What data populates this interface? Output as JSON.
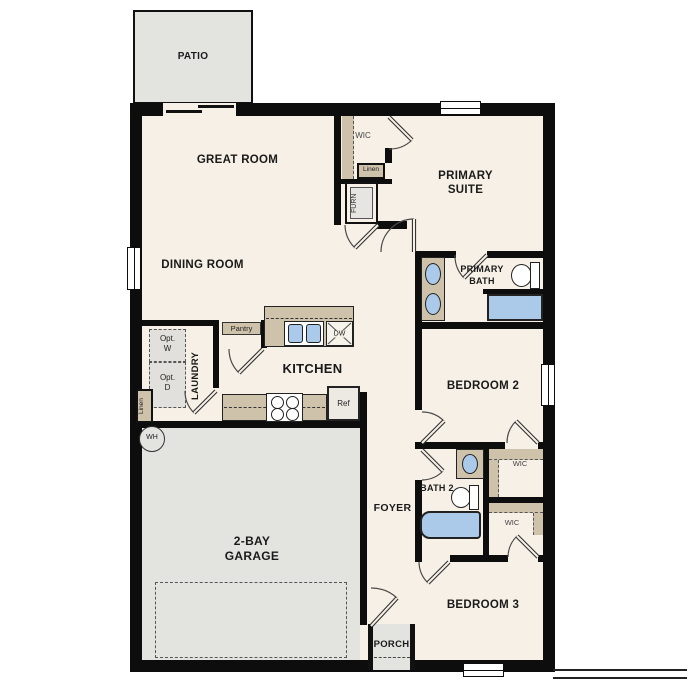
{
  "plan_title": "single-story-floor-plan",
  "colors": {
    "floor": "#f7f0e6",
    "hard": "#e3e3e0",
    "counter": "#cfc2ab",
    "fixture": "#abc9e9",
    "wall": "#0d0d0d"
  },
  "rooms": {
    "patio": "PATIO",
    "great_room": "GREAT ROOM",
    "dining_room": "DINING ROOM",
    "primary_suite": "PRIMARY SUITE",
    "primary_bath": "PRIMARY BATH",
    "wic_primary": "WIC",
    "linen_upper": "Linen",
    "furnace": "FURN",
    "laundry": "LAUNDRY",
    "linen_laundry": "Linen",
    "pantry": "Pantry",
    "kitchen": "KITCHEN",
    "bedroom_2": "BEDROOM 2",
    "bath_2": "BATH 2",
    "wic_bedroom2": "WIC",
    "wic_bedroom3": "WIC",
    "bedroom_3": "BEDROOM 3",
    "foyer": "FOYER",
    "porch": "PORCH",
    "garage": "2-BAY GARAGE"
  },
  "fixtures": {
    "washer_optional": "Opt. W",
    "dryer_optional": "Opt. D",
    "water_heater": "WH",
    "dishwasher": "DW",
    "refrigerator": "Ref"
  }
}
